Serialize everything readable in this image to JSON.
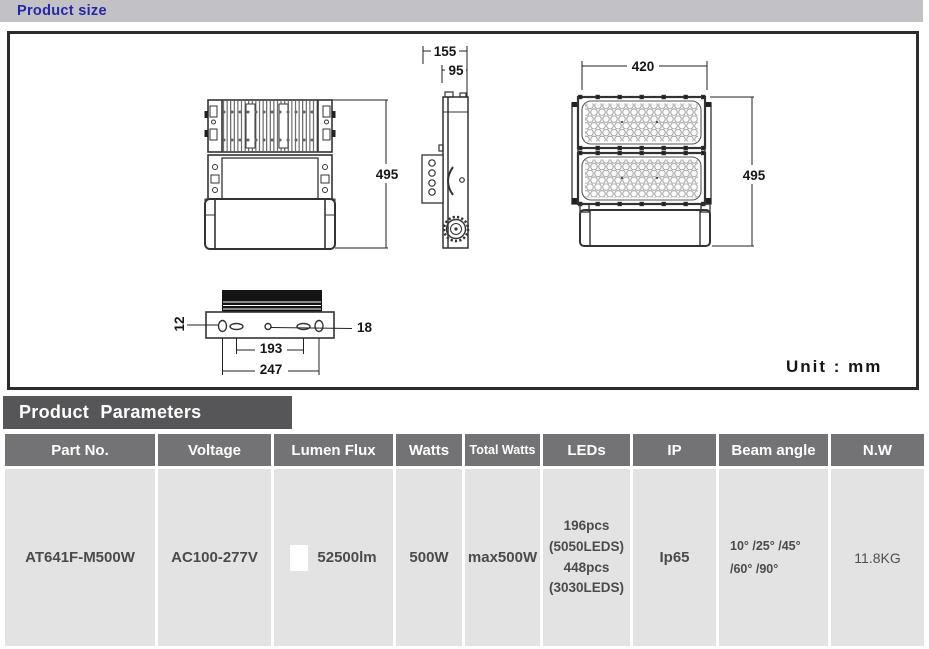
{
  "header": {
    "section_size": "Product size",
    "section_params": "Product  Parameters"
  },
  "drawing": {
    "unit_label": "Unit : mm",
    "dimensions": {
      "back_height": "495",
      "depth_total": "155",
      "depth_body": "95",
      "front_width": "420",
      "front_height": "495",
      "slot_width": "12",
      "hole_diameter": "18",
      "hole_spacing_inner": "193",
      "hole_spacing_outer": "247"
    }
  },
  "table": {
    "columns": [
      "Part No.",
      "Voltage",
      "Lumen Flux",
      "Watts",
      "Total Watts",
      "LEDs",
      "IP",
      "Beam angle",
      "N.W"
    ],
    "row": {
      "part_no": "AT641F-M500W",
      "voltage": "AC100-277V",
      "lumen_flux": "52500lm",
      "watts": "500W",
      "total_watts": "max500W",
      "leds": "196pcs\n(5050LEDS)\n448pcs\n(3030LEDS)",
      "ip": "Ip65",
      "beam_angle": "10° /25° /45°\n/60° /90°",
      "nw": "11.8KG"
    }
  },
  "colors": {
    "accent_blue": "#2626a6",
    "titlebar_gray": "#c2c2c6",
    "params_bar_gray": "#565659",
    "table_header_gray": "#737375",
    "cell_gray": "#e3e3e4",
    "line_dark": "#2c2c2c"
  }
}
